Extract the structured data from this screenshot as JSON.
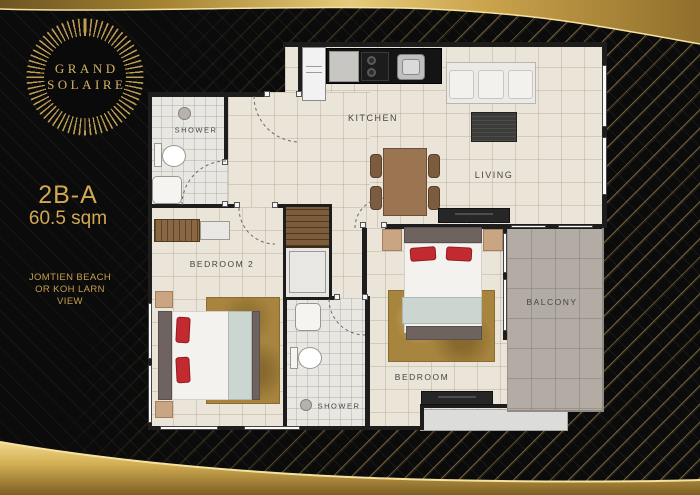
{
  "brand": {
    "line1": "GRAND",
    "line2": "SOLAIRE"
  },
  "unit": {
    "code": "2B-A",
    "area": "60.5 sqm",
    "view_line1": "JOMTIEN BEACH",
    "view_line2": "OR KOH LARN",
    "view_line3": "VIEW"
  },
  "rooms": {
    "kitchen": "KITCHEN",
    "living": "LIVING",
    "balcony": "BALCONY",
    "bedroom": "BEDROOM",
    "bedroom2": "BEDROOM 2",
    "shower_top": "SHOWER",
    "shower_bottom": "SHOWER"
  },
  "colors": {
    "gold_text": "#d2a852",
    "gold_band_light": "#ecd387",
    "gold_band_dark": "#7d5f22",
    "wall": "#1d1d1d",
    "floor_cream": "#ebe4d8",
    "floor_balcony": "#b3aca4",
    "pillow_red": "#c32a30",
    "rug_gold": "#a8853f"
  }
}
